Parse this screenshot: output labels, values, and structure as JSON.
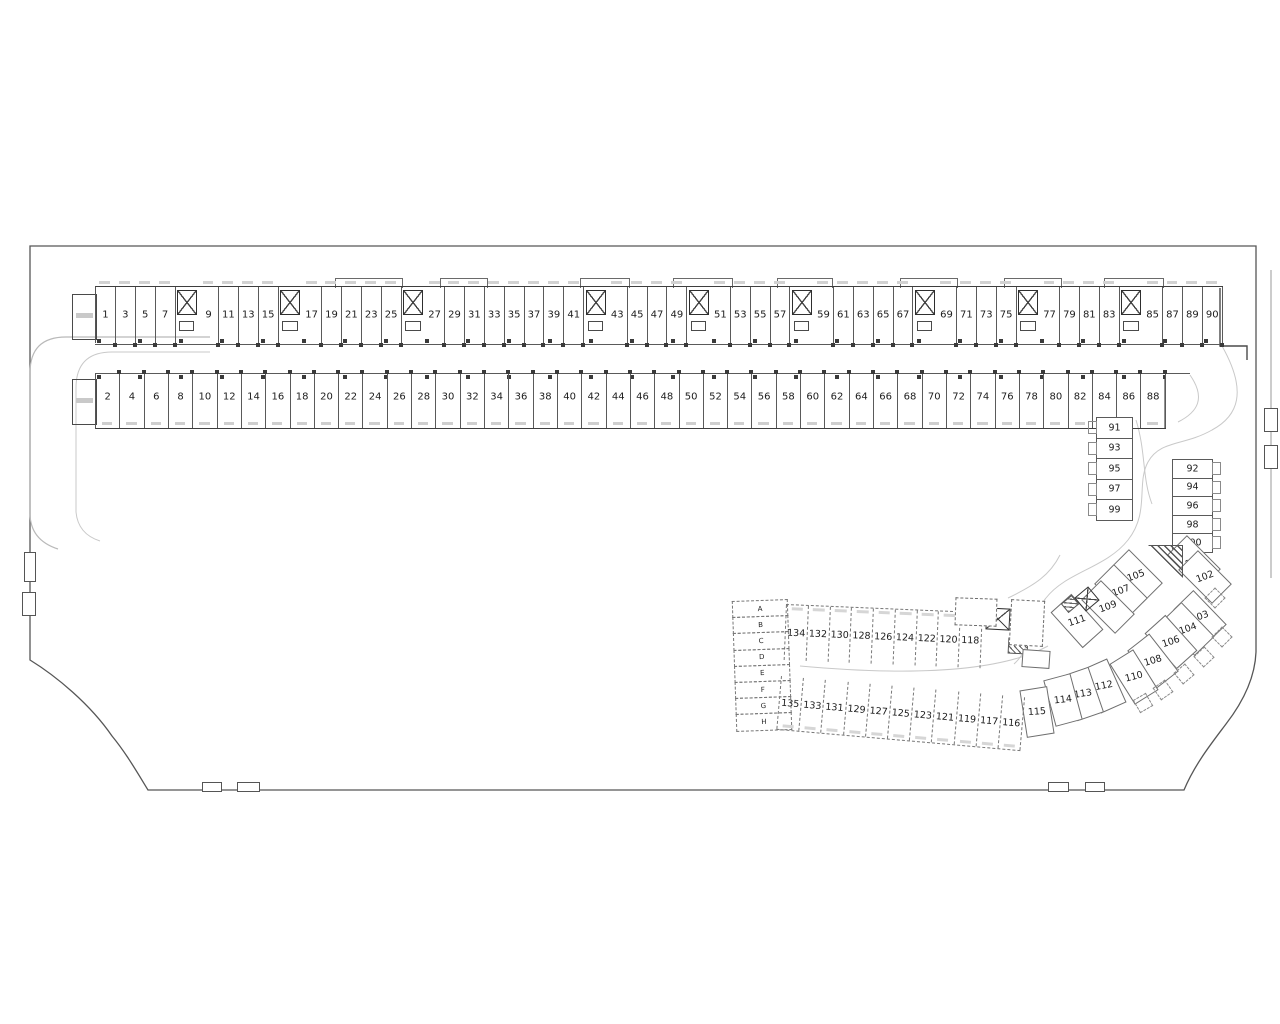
{
  "drawing": {
    "type": "parking-garage-floor-plan",
    "background_color": "#ffffff",
    "wall_line_color": "#4a4a4a",
    "road_line_color": "#c9c9c9",
    "stair_marker": "X",
    "top_row": [
      "1",
      "3",
      "5",
      "7",
      "X",
      "9",
      "11",
      "13",
      "15",
      "X",
      "17",
      "19",
      "21",
      "23",
      "25",
      "X",
      "27",
      "29",
      "31",
      "33",
      "35",
      "37",
      "39",
      "41",
      "X",
      "43",
      "45",
      "47",
      "49",
      "X",
      "51",
      "53",
      "55",
      "57",
      "X",
      "59",
      "61",
      "63",
      "65",
      "67",
      "X",
      "69",
      "71",
      "73",
      "75",
      "X",
      "77",
      "79",
      "81",
      "83",
      "X",
      "85",
      "87",
      "89",
      "90"
    ],
    "bottom_row": [
      "2",
      "4",
      "6",
      "8",
      "10",
      "12",
      "14",
      "16",
      "18",
      "20",
      "22",
      "24",
      "26",
      "28",
      "30",
      "32",
      "34",
      "36",
      "38",
      "40",
      "42",
      "44",
      "46",
      "48",
      "50",
      "52",
      "54",
      "56",
      "58",
      "60",
      "62",
      "64",
      "66",
      "68",
      "70",
      "72",
      "74",
      "76",
      "78",
      "80",
      "82",
      "84",
      "86",
      "88"
    ],
    "right_column_outer": [
      "91",
      "93",
      "95",
      "97",
      "99"
    ],
    "right_column_inner": [
      "92",
      "94",
      "96",
      "98",
      "100"
    ],
    "diagonal_upper": [
      {
        "n": "105",
        "x": 1136,
        "y": 576,
        "r": -45
      },
      {
        "n": "107",
        "x": 1121,
        "y": 591,
        "r": -45
      },
      {
        "n": "109",
        "x": 1108,
        "y": 607,
        "r": -45
      },
      {
        "n": "111",
        "x": 1077,
        "y": 621,
        "r": -42
      }
    ],
    "arc_row": [
      {
        "n": "101",
        "x": 1194,
        "y": 562,
        "r": -45
      },
      {
        "n": "102",
        "x": 1205,
        "y": 577,
        "r": -45
      },
      {
        "n": "103",
        "x": 1200,
        "y": 617,
        "r": -44
      },
      {
        "n": "104",
        "x": 1188,
        "y": 629,
        "r": -44
      },
      {
        "n": "106",
        "x": 1171,
        "y": 642,
        "r": -42
      },
      {
        "n": "108",
        "x": 1153,
        "y": 661,
        "r": -38
      },
      {
        "n": "110",
        "x": 1134,
        "y": 677,
        "r": -32
      },
      {
        "n": "112",
        "x": 1104,
        "y": 686,
        "r": -24
      },
      {
        "n": "113",
        "x": 1083,
        "y": 694,
        "r": -19
      },
      {
        "n": "114",
        "x": 1063,
        "y": 700,
        "r": -15
      },
      {
        "n": "115",
        "x": 1037,
        "y": 712,
        "r": -9
      }
    ],
    "lower_section": {
      "storage_cells": [
        "A",
        "B",
        "C",
        "D",
        "E",
        "F",
        "G",
        "H"
      ],
      "upper_row": [
        "134",
        "132",
        "130",
        "128",
        "126",
        "124",
        "122",
        "120",
        "118"
      ],
      "lower_row": [
        "135",
        "133",
        "131",
        "129",
        "127",
        "125",
        "123",
        "121",
        "119",
        "117",
        "116"
      ]
    }
  }
}
